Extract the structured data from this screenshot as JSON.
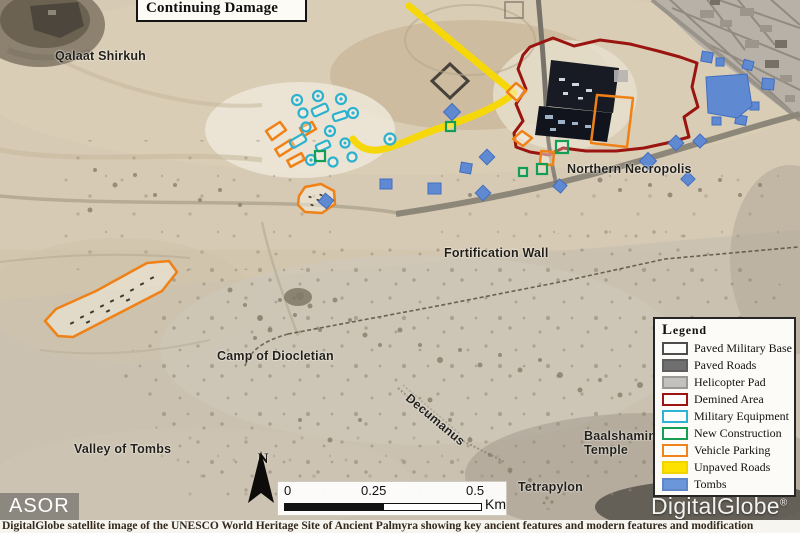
{
  "figure": {
    "title": "Continuing Damage",
    "caption": "DigitalGlobe satellite image of the UNESCO World Heritage Site of Ancient Palmyra showing key ancient features and modern features and modification",
    "credit_left": "ASOR",
    "credit_right": "DigitalGlobe",
    "credit_right_mark": "®"
  },
  "map_labels": [
    {
      "id": "qalaat-shirkuh",
      "text": "Qalaat Shirkuh"
    },
    {
      "id": "northern-necropolis",
      "text": "Northern Necropolis"
    },
    {
      "id": "fortification-wall",
      "text": "Fortification Wall"
    },
    {
      "id": "camp-of-diocletian",
      "text": "Camp of Diocletian"
    },
    {
      "id": "decumanus",
      "text": "Decumanus"
    },
    {
      "id": "baalshamin-temple",
      "text": "Baalshamin\nTemple"
    },
    {
      "id": "valley-of-tombs",
      "text": "Valley of Tombs"
    },
    {
      "id": "tetrapylon",
      "text": "Tetrapylon"
    }
  ],
  "legend": {
    "title": "Legend",
    "items": [
      {
        "label": "Paved Military Base",
        "swatch_style": "background:#fdfdfb;border-color:#4d4d4d"
      },
      {
        "label": "Paved Roads",
        "swatch_style": "background:#6f6f6f;border-color:#5e5e5e"
      },
      {
        "label": "Helicopter Pad",
        "swatch_style": "background:#c2c1bf;border-color:#999894"
      },
      {
        "label": "Demined Area",
        "swatch_style": "background:#fdfdfb;border-color:#9c1512"
      },
      {
        "label": "Military Equipment",
        "swatch_style": "background:#fdfdfb;border-color:#2db4d3"
      },
      {
        "label": "New Construction",
        "swatch_style": "background:#fdfdfb;border-color:#169e55"
      },
      {
        "label": "Vehicle Parking",
        "swatch_style": "background:#fdfdfb;border-color:#f0831a"
      },
      {
        "label": "Unpaved Roads",
        "swatch_style": "background:#ffe100;border-color:#f0d400"
      },
      {
        "label": "Tombs",
        "swatch_style": "background:#6b96d9;border-color:#5e86c8"
      }
    ]
  },
  "scale_bar": {
    "ticks": [
      "0",
      "0.25",
      "0.5"
    ],
    "unit": "Km"
  },
  "north_arrow": {
    "label": "N"
  },
  "colors": {
    "demined_area": "#9a1410",
    "vehicle_parking": "#ef8116",
    "military_equipment": "#2cb2cf",
    "new_construction": "#129e54",
    "unpaved_roads": "#f6d80a",
    "tombs": "#5f8ad2",
    "paved_road": "#8d8779",
    "military_base": "#181b24"
  }
}
